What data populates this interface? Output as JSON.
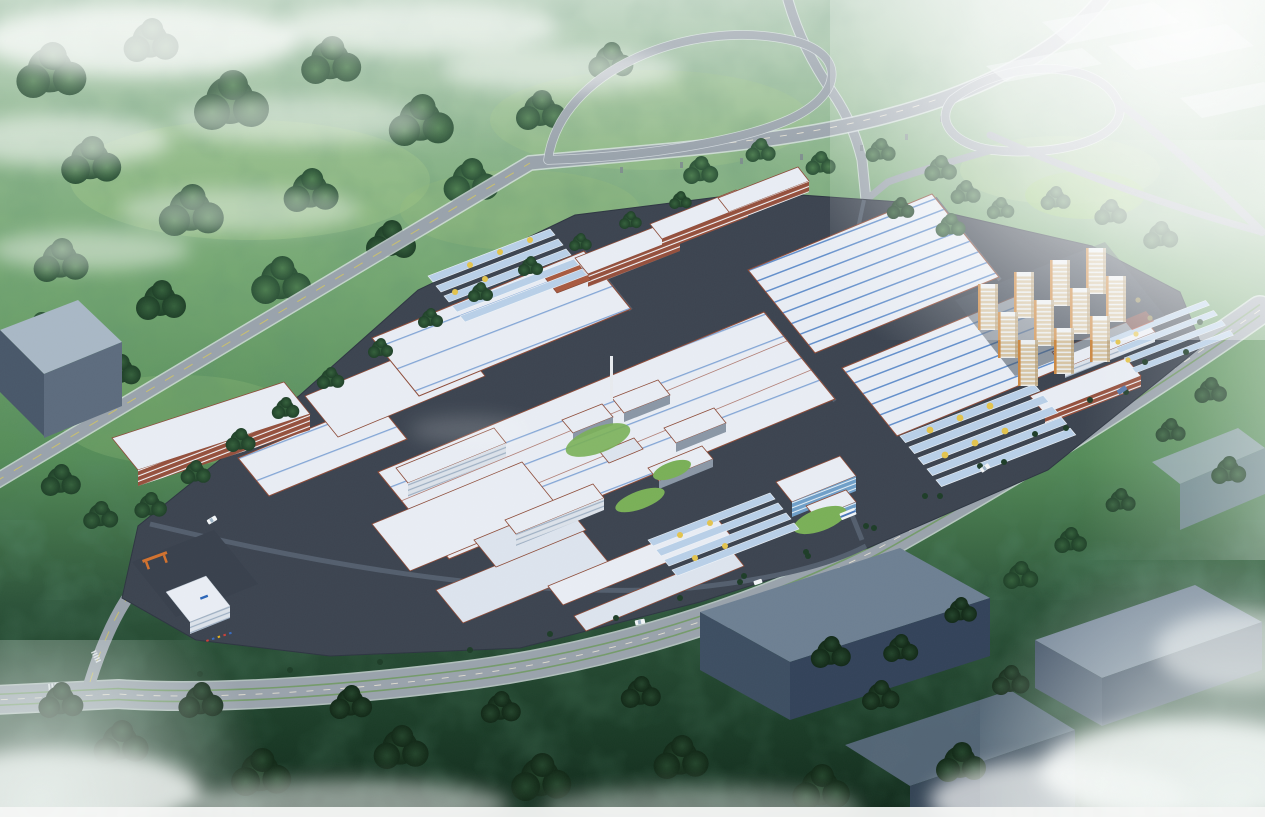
{
  "scene": {
    "type": "aerial-architectural-rendering",
    "subject": "bird's-eye rendering of an industrial park: striped-roof factory halls, red-facade dormitory slabs, residential towers, solar carport rows, a highway interchange in forested surroundings with haze and clouds",
    "regions": [
      "forest",
      "highway-interchange",
      "factory-campus",
      "residential-towers",
      "solar-carports",
      "boulevard",
      "neighboring-warehouses",
      "substation",
      "clouds"
    ]
  },
  "colors": {
    "grass_top": "#a8c6ac",
    "grass_mid": "#76a873",
    "grass_low": "#558c58",
    "forest_dark": "#2c5339",
    "forest_deep": "#122a1c",
    "haze": "#f2f7f5",
    "road_gray": "#9aa3ac",
    "road_edge": "#dfe5e9",
    "lane_dash": "#efe9d8",
    "lane_yellow": "#d6c75e",
    "campus_base": "#3c4450",
    "campus_road": "#545f6e",
    "roof_white": "#e9edf4",
    "roof_pale": "#dde4ee",
    "roof_stripe": "#4d80c6",
    "trim_red": "#8e4c39",
    "facade_red": "#95503d",
    "facade_white": "#dce2ea",
    "floor_line": "#f3f5f8",
    "window_line": "#9fb0c4",
    "glass_blue": "#6f9fc9",
    "panel_blue": "#b9d0e8",
    "panel_edge": "#eef3f8",
    "res_tan": "#d7c5a4",
    "res_white": "#eceff1",
    "res_orange": "#cd8a45",
    "box_top": "#a9b8c6",
    "box_front": "#5d6c7e",
    "box_side": "#49586a",
    "dark_top": "#6e8093",
    "dark_front": "#3d4e62",
    "dark_side": "#33435a",
    "tree_yellow": "#e3c44e",
    "car_white": "#f2f5f7",
    "chimney": "#e8ebef",
    "lawn": "#7ab058"
  }
}
